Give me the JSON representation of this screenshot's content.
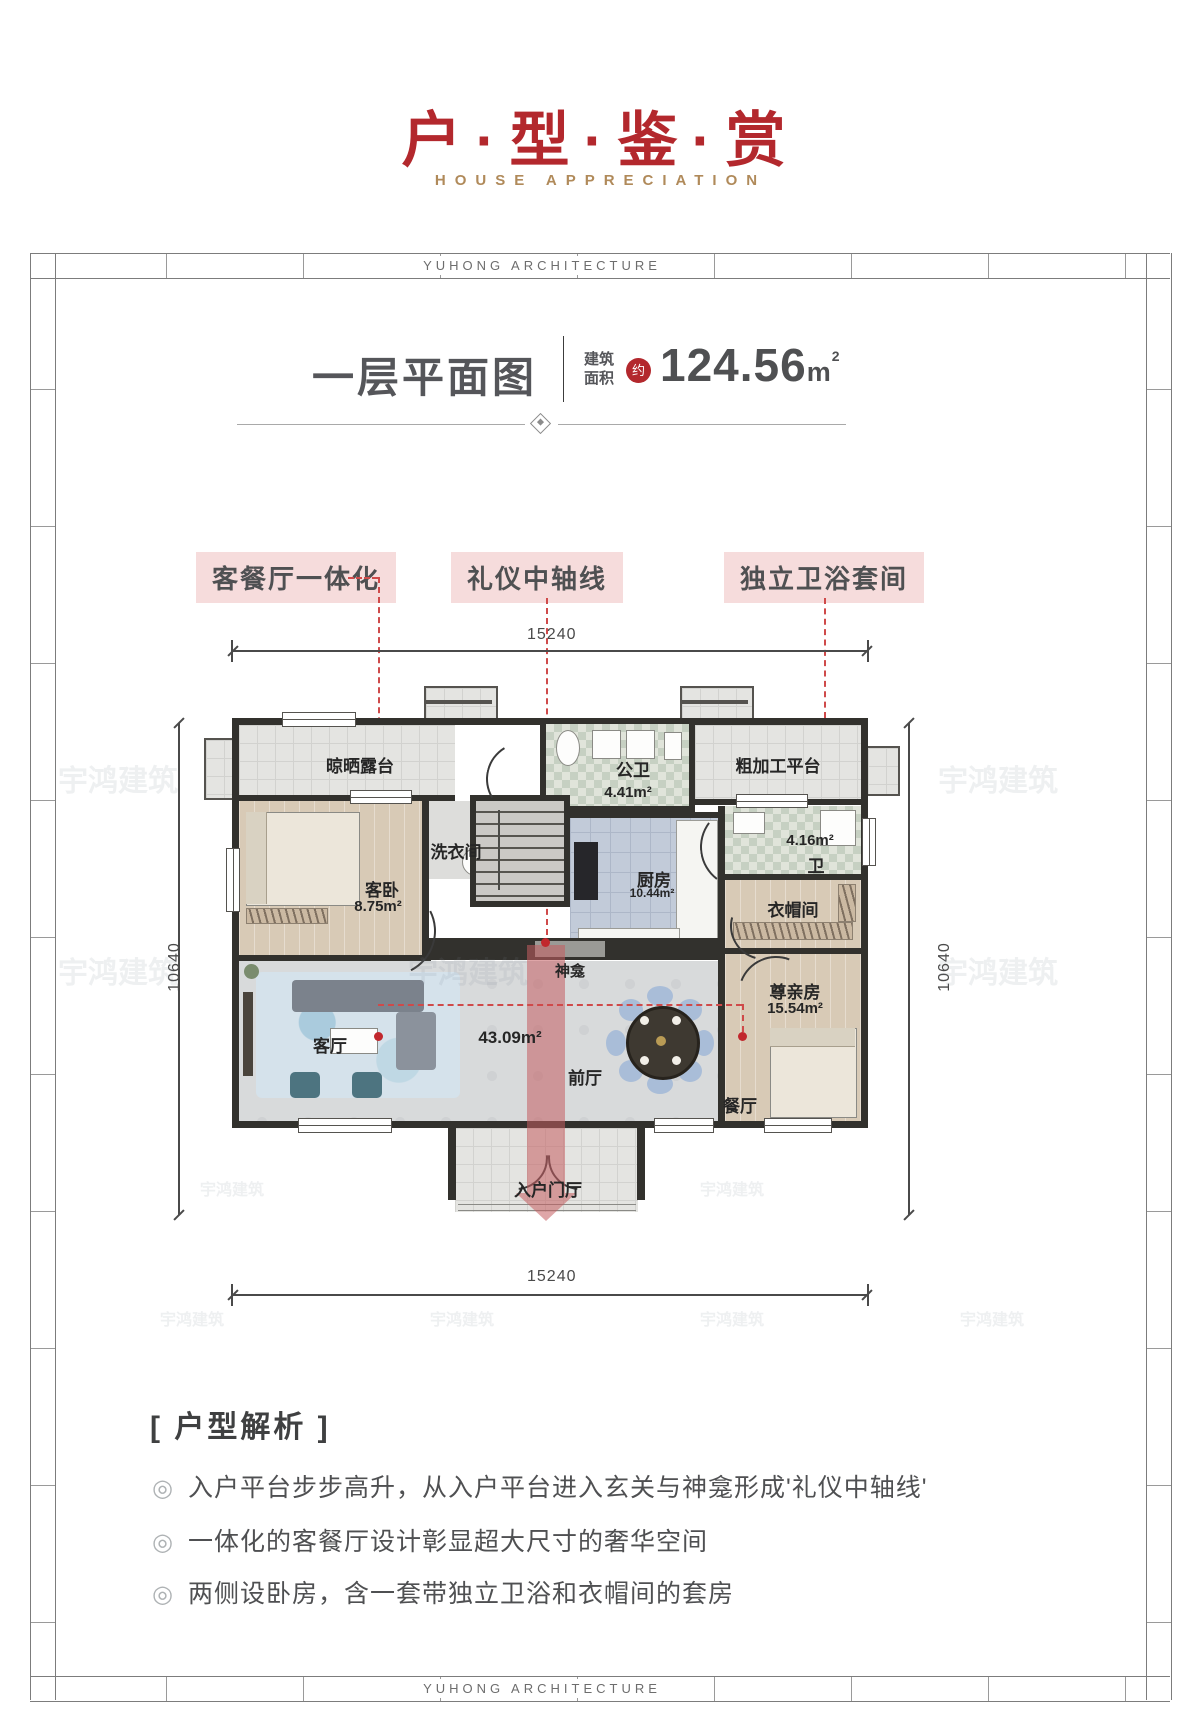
{
  "header": {
    "title": "户·型·鉴·赏",
    "subtitle": "HOUSE APPRECIATION"
  },
  "frame": {
    "brand": "YUHONG ARCHITECTURE"
  },
  "plan_header": {
    "title": "一层平面图",
    "area_label_l1": "建筑",
    "area_label_l2": "面积",
    "approx": "约",
    "value": "124.56",
    "unit": "m",
    "sup": "2"
  },
  "callouts": [
    {
      "label": "客餐厅一体化"
    },
    {
      "label": "礼仪中轴线"
    },
    {
      "label": "独立卫浴套间"
    }
  ],
  "dims": {
    "top": "15240",
    "bottom": "15240",
    "left": "10640",
    "right": "10640"
  },
  "rooms": {
    "terrace": "晾晒露台",
    "laundry": "洗衣间",
    "public_bath": "公卫",
    "public_bath_area": "4.41m²",
    "platform": "粗加工平台",
    "guest_bed": "客卧",
    "guest_bed_area": "8.75m²",
    "kitchen": "厨房",
    "kitchen_area": "10.44m²",
    "suite_bath_area": "4.16m²",
    "suite_bath": "卫",
    "cloak": "衣帽间",
    "shrine": "神龛",
    "living": "客厅",
    "hall_area": "43.09m²",
    "hall": "前厅",
    "dining": "餐厅",
    "elder": "尊亲房",
    "elder_area": "15.54m²",
    "entry": "入户门厅"
  },
  "watermark": {
    "text": "宇鸿建筑"
  },
  "analysis": {
    "heading": "[ 户型解析 ]",
    "bullet": "◎",
    "items": [
      "入户平台步步高升，从入户平台进入玄关与神龛形成'礼仪中轴线'",
      "一体化的客餐厅设计彰显超大尺寸的奢华空间",
      "两侧设卧房，含一套带独立卫浴和衣帽间的套房"
    ]
  }
}
